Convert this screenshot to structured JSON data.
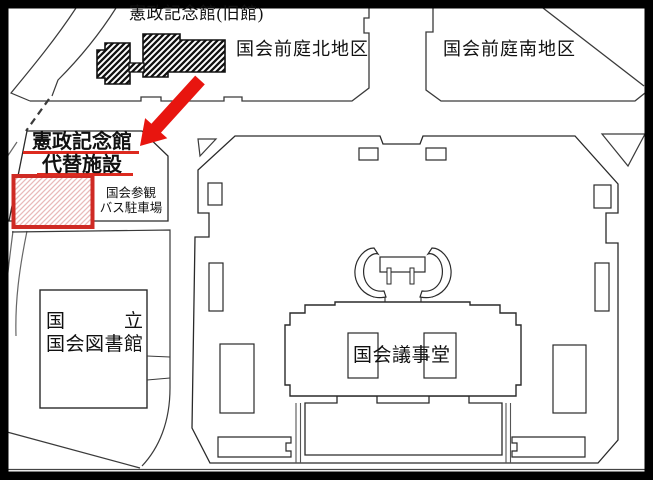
{
  "map_title": "国会議事堂周辺案内図",
  "labels": {
    "old_hall": "憲政記念館(旧館)",
    "north_garden": "国会前庭北地区",
    "south_garden": "国会前庭南地区",
    "facility_line1": "憲政記念館",
    "facility_line2": "代替施設",
    "bus_parking_line1": "国会参観",
    "bus_parking_line2": "バス駐車場",
    "library_line1_left": "国",
    "library_line1_right": "立",
    "library_line2": "国会図書館",
    "diet_building": "国会議事堂"
  },
  "colors": {
    "highlight_red": "#e8150f",
    "underline_red": "#dd2a1f",
    "box_border_red": "#cf2a24",
    "box_hatch_pink": "#e9b9b9",
    "line_dark": "#3a3a3a",
    "frame_black": "#000000"
  }
}
